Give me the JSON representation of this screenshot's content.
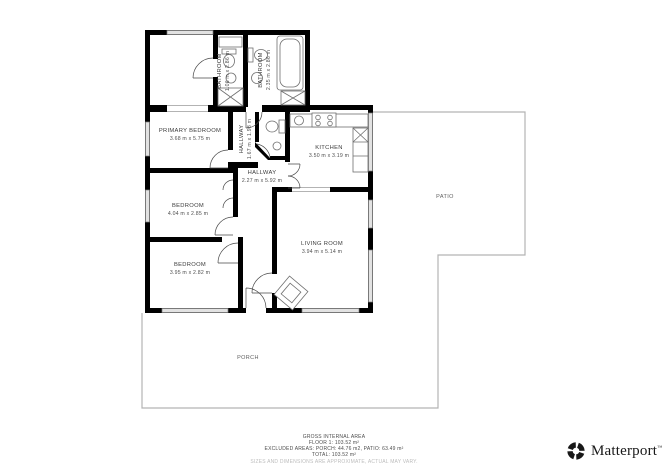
{
  "rooms": {
    "primary_bedroom": {
      "name": "PRIMARY BEDROOM",
      "dims": "3.68 m x 5.75 m"
    },
    "bathroom_small": {
      "name": "BATHROOM",
      "dims": "1.06 m x 2.86 m"
    },
    "bathroom": {
      "name": "BATHROOM",
      "dims": "2.35 m x 2.86 m"
    },
    "hallway_small": {
      "name": "HALLWAY",
      "dims": "1.67 m x 1.98 m"
    },
    "hallway_main": {
      "name": "HALLWAY",
      "dims": "2.27 m x 5.92 m"
    },
    "kitchen": {
      "name": "KITCHEN",
      "dims": "3.50 m x 3.19 m"
    },
    "bedroom_mid": {
      "name": "BEDROOM",
      "dims": "4.04 m x 2.85 m"
    },
    "bedroom_bottom": {
      "name": "BEDROOM",
      "dims": "3.95 m x 2.82 m"
    },
    "living_room": {
      "name": "LIVING ROOM",
      "dims": "3.94 m x 5.14 m"
    },
    "patio": {
      "name": "PATIO"
    },
    "porch": {
      "name": "PORCH"
    }
  },
  "footer": {
    "line1": "GROSS INTERNAL AREA",
    "line2": "FLOOR 1: 103.52 m²",
    "line3": "EXCLUDED AREAS: PORCH: 44.76 m2, PATIO: 63.49 m²",
    "line4": "TOTAL: 103.52 m²",
    "disclaimer": "SIZES AND DIMENSIONS ARE APPROXIMATE, ACTUAL MAY VARY."
  },
  "brand": {
    "name": "Matterport",
    "tm": "™"
  },
  "colors": {
    "wall": "#000000",
    "exterior_outline": "#b3b3b3",
    "fixture_stroke": "#6f6f6f",
    "window_fill": "#e2e2e2",
    "label_text": "#3c3c3c",
    "footer_text": "#4d4d4d",
    "disclaimer_text": "#bdbdbd",
    "brand_text": "#181818"
  }
}
